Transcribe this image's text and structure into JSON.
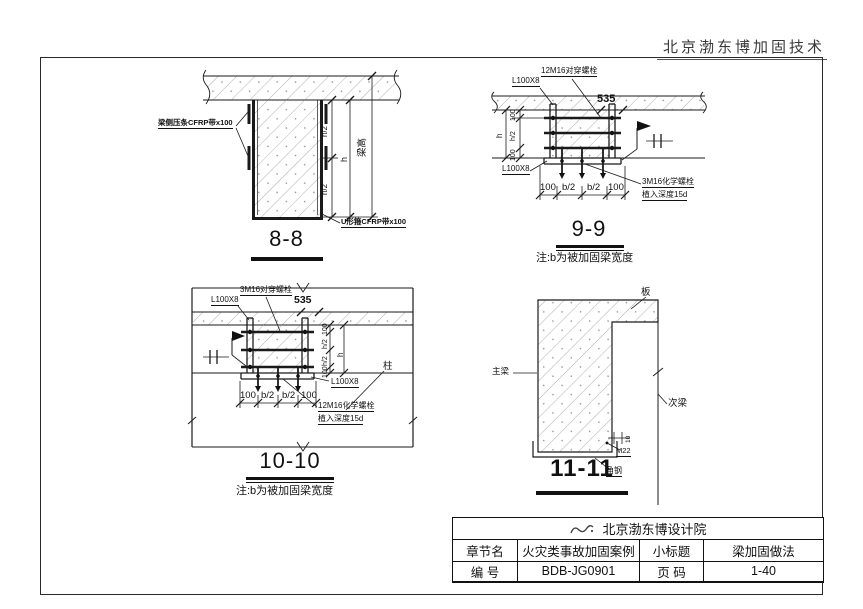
{
  "page": {
    "header_company": "北京渤东博加固技术"
  },
  "sections": {
    "s8": {
      "title": "8-8",
      "labels": {
        "side_strip": "梁侧压条CFRP带x100",
        "u_wrap": "U形箍CFRP带x100"
      },
      "dims": {
        "h_half_top": "h/2",
        "h_half_bottom": "h/2",
        "h": "h",
        "beam_height": "梁高"
      }
    },
    "s9": {
      "title": "9-9",
      "note": "注:b为被加固梁宽度",
      "labels": {
        "angle_top": "L100X8",
        "angle_bottom": "L100X8",
        "through_bolts": "12M16对穿螺栓",
        "chem_bolts": "3M16化学螺栓",
        "embed_depth": "植入深度15d"
      },
      "dims": {
        "top": "535",
        "left": [
          "100",
          "h/2",
          "h",
          "100"
        ],
        "bottom": [
          "100",
          "b/2",
          "b/2",
          "100"
        ]
      }
    },
    "s10": {
      "title": "10-10",
      "note": "注:b为被加固梁宽度",
      "labels": {
        "angle_top": "L100X8",
        "angle_right": "L100X8",
        "through_bolts": "3M16对穿螺栓",
        "chem_bolts": "12M16化学螺栓",
        "embed_depth": "植入深度15d",
        "column": "柱"
      },
      "dims": {
        "top": "535",
        "right": [
          "100",
          "h/2",
          "h/2",
          "h",
          "100"
        ],
        "bottom": [
          "100",
          "b/2",
          "b/2",
          "100"
        ]
      }
    },
    "s11": {
      "title": "11-11",
      "labels": {
        "slab": "板",
        "main_beam": "主梁",
        "secondary_beam": "次梁",
        "bolt": "M22",
        "dim_small": "10",
        "angle_steel": "角钢"
      }
    }
  },
  "title_block": {
    "company": "北京渤东博设计院",
    "rows": [
      {
        "c1": "章节名",
        "c2": "火灾类事故加固案例",
        "c3": "小标题",
        "c4": "梁加固做法"
      },
      {
        "c1": "编  号",
        "c2": "BDB-JG0901",
        "c3": "页  码",
        "c4": "1-40"
      }
    ]
  }
}
